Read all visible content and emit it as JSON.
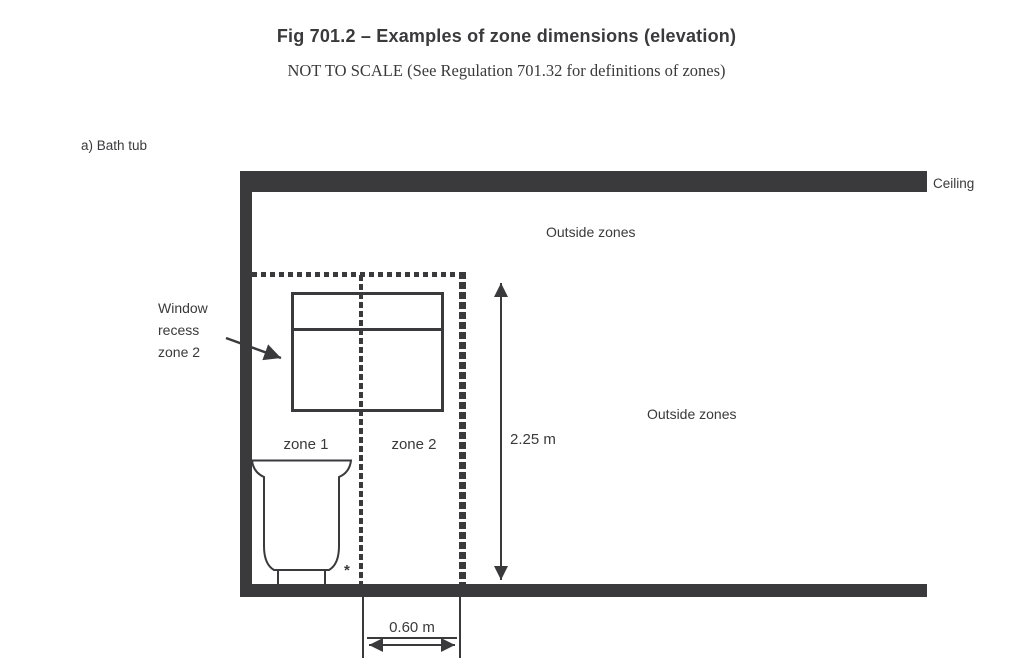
{
  "ink_color": "#3a3a3c",
  "figure": {
    "title": "Fig 701.2 – Examples of zone dimensions (elevation)",
    "subtitle": "NOT TO SCALE (See Regulation 701.32 for definitions of zones)",
    "part_label": "a) Bath tub"
  },
  "diagram": {
    "ceiling_label": "Ceiling",
    "outside_zones_top": "Outside zones",
    "outside_zones_right": "Outside zones",
    "window_recess_label": "Window\nrecess\nzone 2",
    "zone1_label": "zone 1",
    "zone2_label": "zone 2",
    "zone0_label": "zone 0",
    "asterisk_note": "*",
    "height_dimension": "2.25 m",
    "width_dimension": "0.60 m"
  }
}
